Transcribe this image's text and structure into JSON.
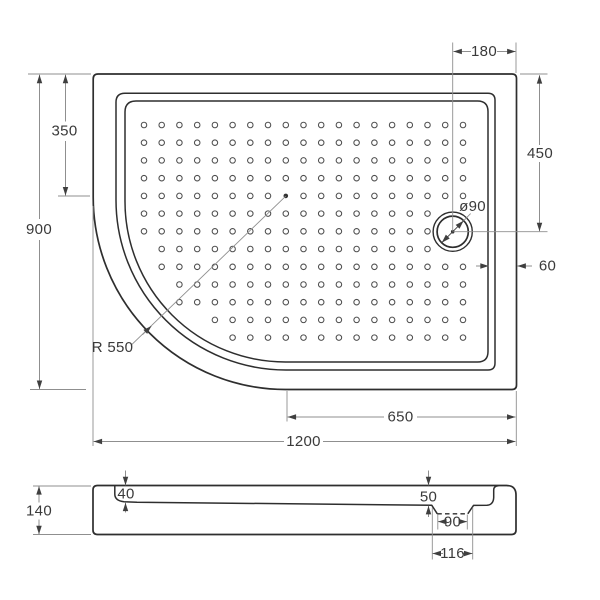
{
  "plan": {
    "height": "900",
    "straight": "350",
    "top_offset": "180",
    "drain_offset": "450",
    "rim": "60",
    "drain_dia": "ø90",
    "radius": "R 550",
    "drain_right": "650",
    "width": "1200"
  },
  "section": {
    "height": "140",
    "depth_left": "40",
    "depth_drain": "50",
    "hole": "90",
    "recess": "116"
  },
  "colors": {
    "outline": "#2e2e2e",
    "dim_line": "#8f8f8f",
    "arrow": "#3f3f3f",
    "text": "#3a3a3a",
    "dot": "#4f4f4f",
    "background": "#ffffff"
  }
}
